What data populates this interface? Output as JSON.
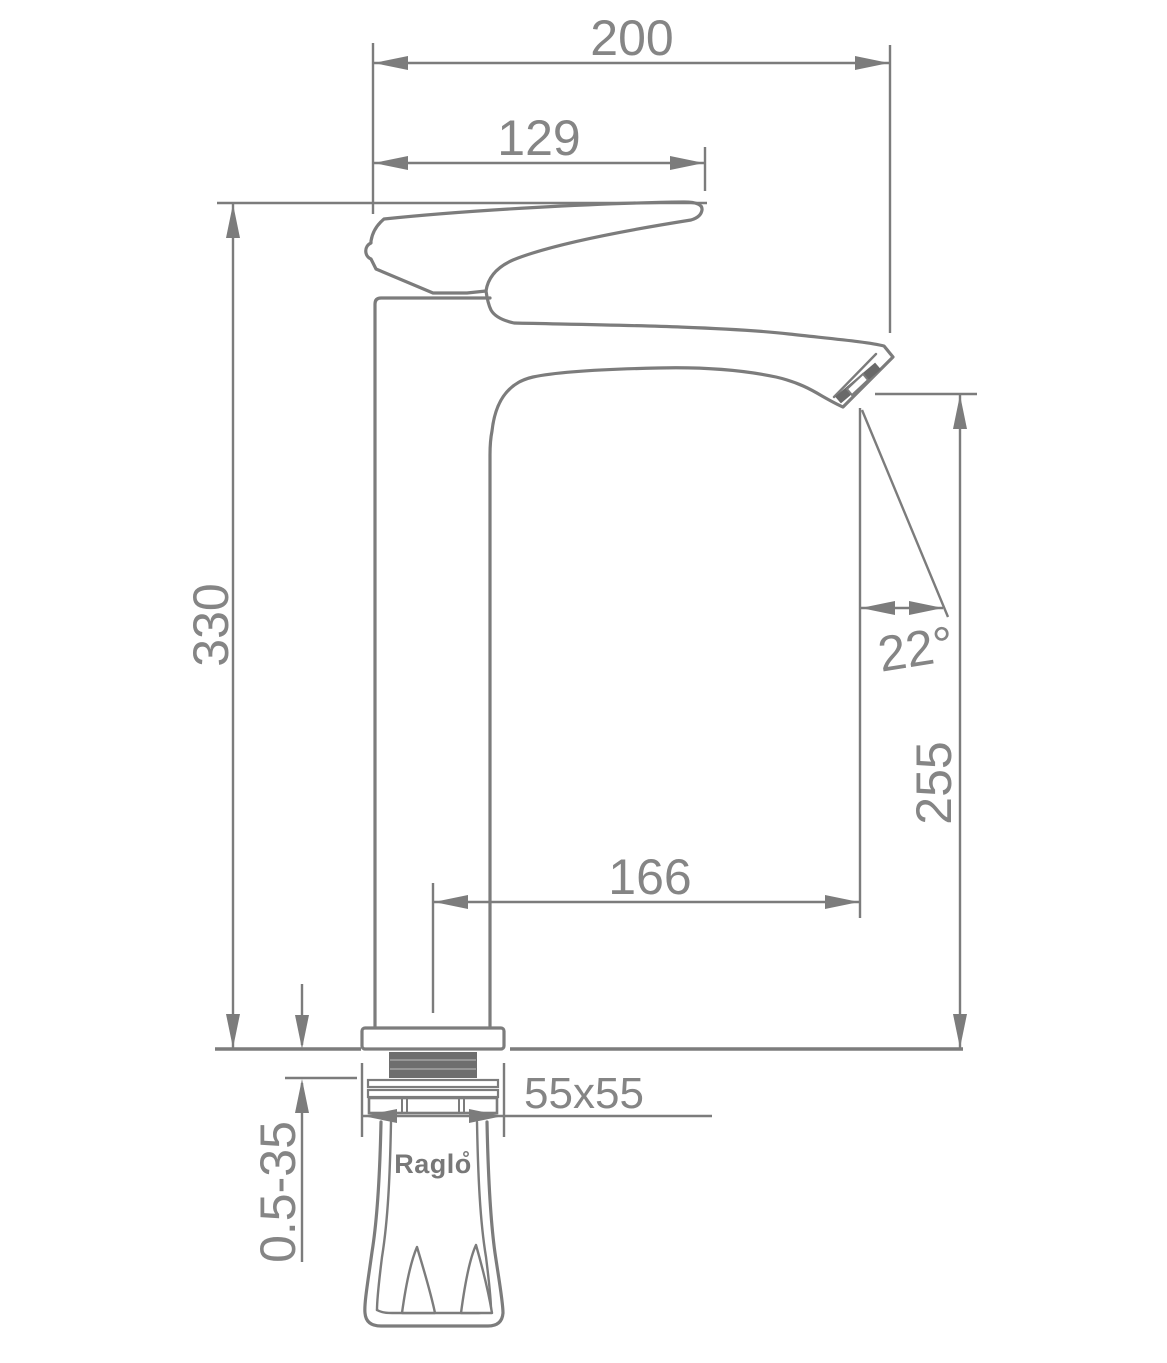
{
  "dims": {
    "top_width": "200",
    "handle_reach": "129",
    "overall_height": "330",
    "outlet_height": "255",
    "spout_reach": "166",
    "spout_angle": "22°",
    "base_size": "55x55",
    "clamp_range": "0.5-35"
  },
  "brand": {
    "name": "Raglo"
  },
  "colors": {
    "line": "#7c7c7c",
    "text": "#858585",
    "logo": "#787878",
    "thread": "#6e6e6e",
    "band": "#696969",
    "background": "#ffffff"
  }
}
